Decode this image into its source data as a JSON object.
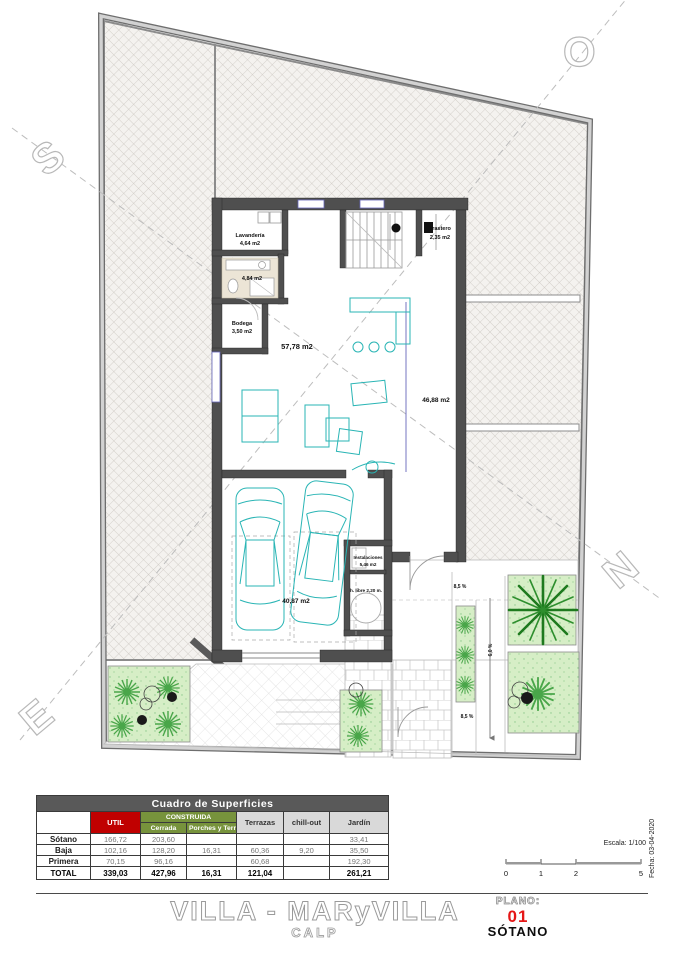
{
  "plan": {
    "compass": {
      "s": "S",
      "o": "O",
      "n": "N",
      "e": "E"
    },
    "labels": {
      "lavanderia_name": "Lavandería",
      "lavanderia_area": "4,64 m2",
      "bath_area": "4,84 m2",
      "bodega_name": "Bodega",
      "bodega_area": "3,50 m2",
      "trastero_name": "Trastero",
      "trastero_area": "2,35 m2",
      "salon_area": "57,78 m2",
      "east_area": "46,88 m2",
      "garage_area": "40,87 m2",
      "instalaciones_name": "Instalaciones",
      "instalaciones_area": "5,46 m2",
      "headroom": "h. libre 2,20 m.",
      "slope_top": "8,5 %",
      "slope_bottom": "8,5 %",
      "slope_ramp": "6,0 %"
    }
  },
  "surfaces_table": {
    "title": "Cuadro de Superficies",
    "headers": {
      "util": "UTIL",
      "construida": "CONSTRUIDA",
      "cerrada": "Cerrada",
      "porches": "Porches y Terrazas",
      "terrazas": "Terrazas",
      "chillout": "chill-out",
      "jardin": "Jardín"
    },
    "rows": [
      {
        "label": "Sótano",
        "util": "166,72",
        "cerrada": "203,60",
        "porches": "",
        "terrazas": "",
        "chillout": "",
        "jardin": "33,41"
      },
      {
        "label": "Baja",
        "util": "102,16",
        "cerrada": "128,20",
        "porches": "16,31",
        "terrazas": "60,36",
        "chillout": "9,20",
        "jardin": "35,50"
      },
      {
        "label": "Primera",
        "util": "70,15",
        "cerrada": "96,16",
        "porches": "",
        "terrazas": "60,68",
        "chillout": "",
        "jardin": "192,30"
      },
      {
        "label": "TOTAL",
        "util": "339,03",
        "cerrada": "427,96",
        "porches": "16,31",
        "terrazas": "121,04",
        "chillout": "",
        "jardin": "261,21"
      }
    ]
  },
  "title_block": {
    "fecha": "Fecha: 03-04-2020",
    "escala": "Escala: 1/100",
    "ticks": [
      "0",
      "1",
      "2",
      "5"
    ],
    "plano_label": "PLANO:",
    "plano_number": "01",
    "plano_name": "SÓTANO"
  },
  "footer": {
    "project_title": "VILLA - MARyVILLA",
    "location": "CALP"
  },
  "colors": {
    "accent_red": "#c00000",
    "header_green": "#77933c",
    "header_gray": "#d9d9d9",
    "title_gray": "#595959",
    "furniture_teal": "#2ab5b5",
    "garden_green": "#d6eec6",
    "palm_green": "#1e7a1e"
  }
}
